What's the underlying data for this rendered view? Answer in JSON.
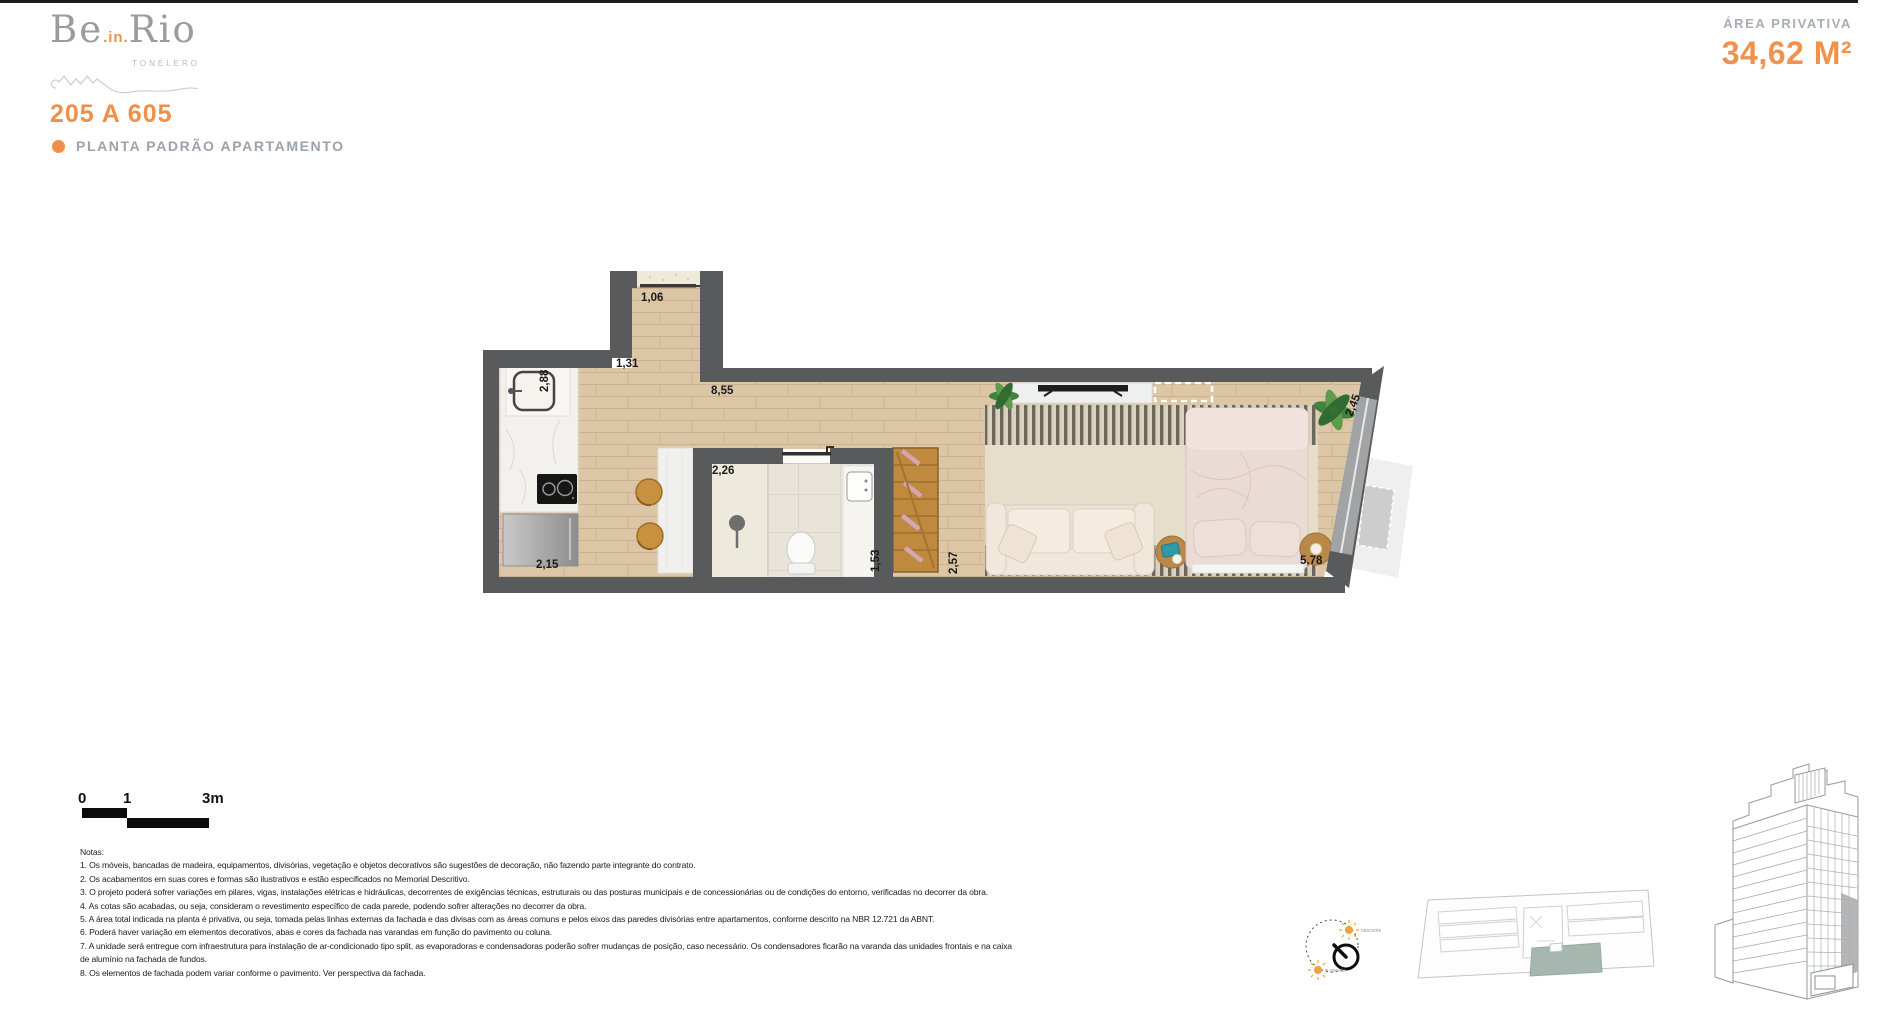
{
  "logo": {
    "be": "Be",
    "in": ".in.",
    "rio": "Rio",
    "subtitle": "TONELERO"
  },
  "header": {
    "unit_range": "205 A 605",
    "plan_type": "PLANTA PADRÃO APARTAMENTO",
    "area_label": "ÁREA PRIVATIVA",
    "area_value": "34,62 M²"
  },
  "colors": {
    "accent_orange": "#EF8F4A",
    "wall_gray": "#595A5C",
    "wood_floor": "#DCC6A6",
    "keyplan_highlight": "#A6B7B0",
    "compass_sun": "#F1A33B"
  },
  "plan": {
    "dims": {
      "entry_door": "1,06",
      "entry_hall": "1,31",
      "kitchen_side": "2,88",
      "living_top": "8,55",
      "bathroom_width": "2,26",
      "kitchen_front": "2,15",
      "bathroom_depth": "1,53",
      "shelf_wall": "2,57",
      "bedroom_front": "5,78",
      "facade_angle": "2,45"
    }
  },
  "scale_bar": {
    "tick_zero": "0",
    "tick_one": "1",
    "tick_three": "3m"
  },
  "notes": {
    "title": "Notas:",
    "items": [
      "1. Os móveis, bancadas de madeira, equipamentos, divisórias, vegetação e objetos decorativos são sugestões de decoração, não fazendo parte integrante do contrato.",
      "2. Os acabamentos em suas cores e formas são ilustrativos e estão especificados no Memorial Descritivo.",
      "3. O projeto poderá sofrer variações em pilares, vigas, instalações elétricas e hidráulicas, decorrentes de exigências técnicas, estruturais ou das posturas municipais e de concessionárias ou de condições do entorno, verificadas no decorrer da obra.",
      "4. As cotas são acabadas, ou seja, consideram o revestimento específico de cada parede, podendo sofrer alterações no decorrer da obra.",
      "5. A área total indicada na planta é privativa, ou seja, tomada pelas linhas externas da fachada e das divisas com as áreas comuns e pelos eixos das paredes divisórias entre apartamentos, conforme descrito na NBR 12.721 da ABNT.",
      "6. Poderá haver variação em elementos decorativos, abas e cores da fachada nas varandas em função do pavimento ou coluna.",
      "7. A unidade será entregue com infraestrutura para instalação de ar-condicionado tipo split, as evaporadoras e condensadoras poderão sofrer mudanças de posição, caso necessário. Os condensadores ficarão na varanda das unidades frontais e na caixa de alumínio na fachada de fundos.",
      "8. Os elementos de fachada podem variar conforme o pavimento. Ver perspectiva da fachada."
    ]
  },
  "compass": {
    "sunrise_label": "nascente",
    "sunset_label": "poente"
  }
}
